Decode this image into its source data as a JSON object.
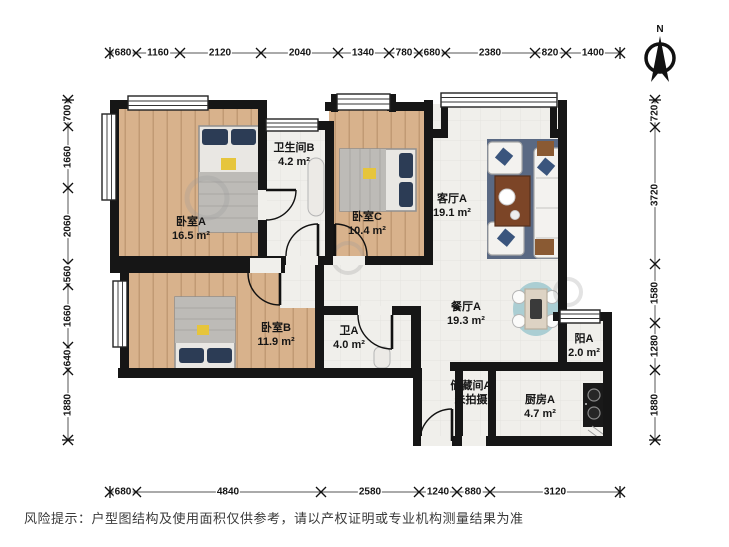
{
  "compass": {
    "north_label": "N"
  },
  "rooms": {
    "bedroomA": {
      "name": "卧室A",
      "area": "16.5 m²"
    },
    "bathB": {
      "name": "卫生间B",
      "area": "4.2 m²"
    },
    "bedroomC": {
      "name": "卧室C",
      "area": "10.4 m²"
    },
    "living": {
      "name": "客厅A",
      "area": "19.1 m²"
    },
    "bedroomB": {
      "name": "卧室B",
      "area": "11.9 m²"
    },
    "toiletA": {
      "name": "卫A",
      "area": "4.0 m²"
    },
    "dining": {
      "name": "餐厅A",
      "area": "19.3 m²"
    },
    "balcony": {
      "name": "阳A",
      "area": "2.0 m²"
    },
    "storage": {
      "name": "储藏间A",
      "area": "未拍摄"
    },
    "kitchen": {
      "name": "厨房A",
      "area": "4.7 m²"
    }
  },
  "dimensions": {
    "top": [
      "680",
      "1160",
      "2120",
      "2040",
      "1340",
      "780",
      "680",
      "2380",
      "820",
      "1400"
    ],
    "bottom": [
      "680",
      "4840",
      "2580",
      "1240",
      "880",
      "3120"
    ],
    "left": [
      "700",
      "1660",
      "2060",
      "560",
      "1660",
      "640",
      "1880"
    ],
    "right": [
      "720",
      "3720",
      "1580",
      "1280",
      "1880"
    ]
  },
  "disclaimer": "风险提示：户型图结构及使用面积仅供参考，请以产权证明或专业机构测量结果为准"
}
